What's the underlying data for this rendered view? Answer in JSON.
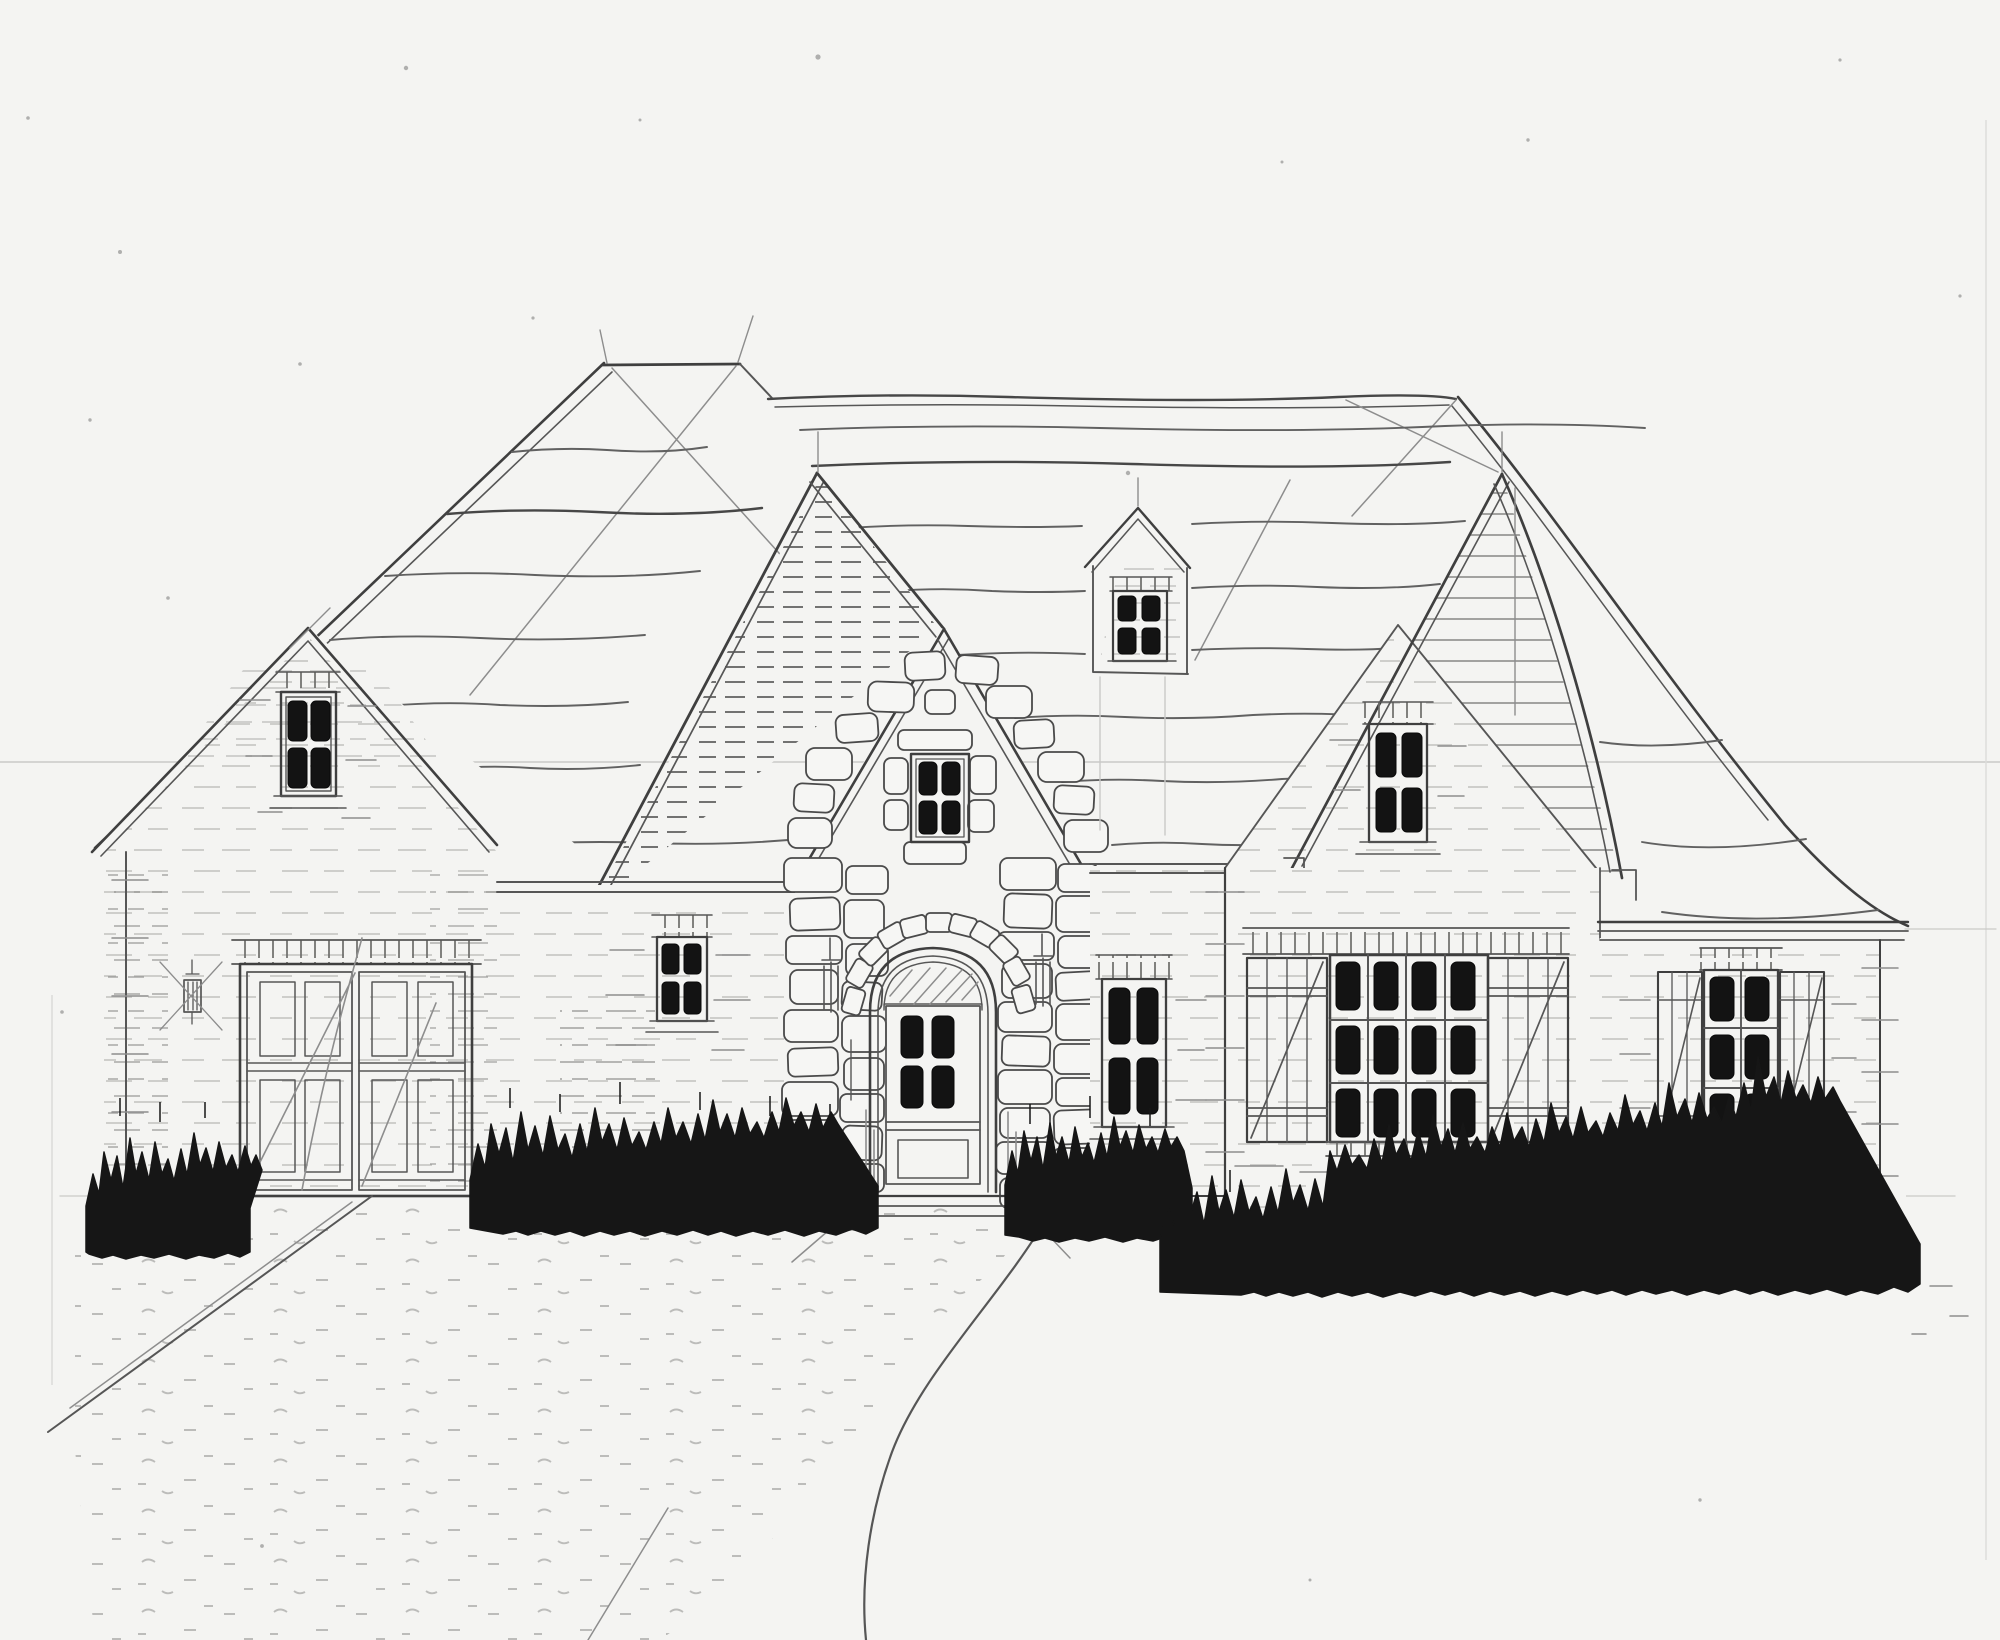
{
  "scene": {
    "type": "hand-drawn architectural sketch",
    "view": "front elevation",
    "subject": "French-country style house with stone arched entry, twin brick gables, garage wing, gable dormer, shuttered windows, dark ink shrubs and a cobblestone drive",
    "medium": "pencil and ink on white paper",
    "aria_label": "Pencil and ink sketch of a French country house front elevation: steep shingled roofs, a stone-trimmed arched entry door, a small gable dormer, brick walls with tick hatching, shuttered multi-pane windows, a double garage door at left, solid black shrubs along the foundation and a sketched cobblestone driveway"
  },
  "palette": {
    "paper": "#f4f4f2",
    "pencil_light": "#8d8d8d",
    "ink_medium": "#565656",
    "ink_dark": "#3f3f3f",
    "marker_black": "#161616"
  },
  "features": {
    "roof": {
      "style": "hipped main roof with three front gables",
      "texture": "freehand shingle lines"
    },
    "garage": {
      "label": "double carriage garage door",
      "doors": 2,
      "panels_per_door": 4
    },
    "entry": {
      "label": "arched entry door",
      "panes": 4,
      "surround": "rubble stone with voussoir arch"
    },
    "dormer": {
      "label": "gable dormer",
      "panes": 4
    },
    "windows": [
      {
        "id": "garage-gable-window",
        "panes": 4
      },
      {
        "id": "left-wall-window",
        "panes": 4
      },
      {
        "id": "stone-gable-window",
        "panes": 4
      },
      {
        "id": "dormer-window",
        "panes": 4
      },
      {
        "id": "right-of-entry-window",
        "panes": 4
      },
      {
        "id": "right-gable-window",
        "panes": 4
      },
      {
        "id": "right-wing-picture-window",
        "panes": 12,
        "shutters": "board-and-batten"
      },
      {
        "id": "far-right-window",
        "panes": 6,
        "shutters": "board-and-batten"
      }
    ],
    "landscape": {
      "shrub_clusters": 4,
      "driveway": "cobblestone drive sweeping to lower left",
      "walkway": "curved front walk"
    }
  }
}
